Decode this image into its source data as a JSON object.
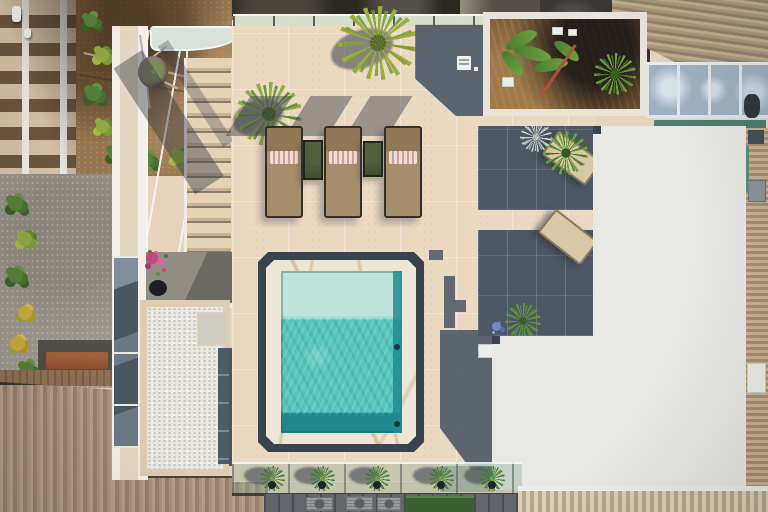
{
  "scene": {
    "type": "aerial-photograph",
    "title": "Top-down drone view of a rooftop terrace with plunge pool, sun loungers and bamboo-slat pergola",
    "lighting": "bright sunlight, shadows cast toward upper-left"
  },
  "palette": {
    "deck_tile": "#ecd9c2",
    "pool_shallow": "#bfe2db",
    "pool_main": "#57c5bc",
    "pool_bench": "#1f888d",
    "marble_surround": "#ede5d6",
    "marble_vein_gold": "#ba8e40",
    "pool_frame_slate": "#39434e",
    "shadow_slate": "#4d5765",
    "pergola_frame": "#e8e9e5",
    "bamboo_light": "#c29a52",
    "bamboo_mid": "#a97f43",
    "bamboo_dark": "#6e5230",
    "glass_panel": "#49545f",
    "lounger_fabric": "#a68d6d",
    "towel_stripe": "#cf9b92",
    "side_table_green": "#47563a",
    "dirt_lot": "#96764f",
    "roof_brown_sw": "#a8917d",
    "roof_corrugated_ne": "#ab997e",
    "pebbles_white": "#e9e7e1",
    "foliage_green": "#55803a",
    "bougainvillea_pink": "#c2487f",
    "teal_glass": "#4f7d71",
    "awning_green": "#3a5f33"
  },
  "terrace": {
    "pool": {
      "shape": "rectangular with chamfered slate border",
      "zones": [
        "pale shallow ledge",
        "turquoise main basin",
        "dark teal bench"
      ],
      "underwater_lights": 2,
      "surround": "white marble with gold veining"
    },
    "sun_loungers": {
      "count": 3,
      "fabric": "taupe",
      "towels": {
        "count": 3,
        "pattern": "pink and white stripes"
      }
    },
    "side_tables": {
      "count": 2,
      "color": "dark green"
    },
    "covered_loungers": {
      "count": 2,
      "fabric": "cream",
      "location": "under glass pergola panels"
    },
    "staircase": {
      "steps_visible": 13,
      "railing": "glass with white stringers",
      "skylight": "sloped glazing beside stairs"
    },
    "pebble_garden": {
      "stone": "white gravel",
      "accents": [
        "grey mat",
        "slate paver strip",
        "bougainvillea pot"
      ]
    },
    "pergola": {
      "infill": "bamboo mats and glass panels",
      "upper_grid": {
        "rows": 4,
        "cols": 3,
        "pattern": [
          [
            "glass",
            "dark",
            "light"
          ],
          [
            "glass",
            "light",
            "light"
          ],
          [
            "glass",
            "mid",
            "light"
          ],
          [
            "glass",
            "light",
            "mid"
          ]
        ]
      },
      "lower_grid": {
        "rows": 3,
        "cols": 5,
        "pattern": [
          [
            "mid",
            "dark",
            "light",
            "dark",
            "light"
          ],
          [
            "mid",
            "light",
            "dark",
            "light",
            "mid"
          ],
          [
            "light",
            "mid",
            "light",
            "dark",
            "mid"
          ]
        ]
      }
    },
    "planter_bed": {
      "plants": [
        "banana",
        "fan palm",
        "red-stem heliconia"
      ],
      "ground": "dry mulch"
    },
    "ground_sign": {
      "legible": false,
      "color": "white"
    }
  },
  "plants": {
    "south_pot_row": {
      "count": 5,
      "type": "spiky agave in dark pots"
    },
    "pot_row_x": [
      272,
      322,
      377,
      441,
      492
    ],
    "pot_row_y": 478,
    "deck_specimens": [
      "yucca at north edge",
      "yucca beside stairs",
      "palm by covered loungers",
      "palm and agapanthus at pergola corner"
    ]
  },
  "surroundings": {
    "north": "dark neighbouring rooftops behind glass balustrade",
    "north_east": "corrugated metal roof, glass conservatory band, teal glazing",
    "east": "tan corrugated neighbour wall",
    "west": "vacant dirt lot with shrubs, tiled roofs, courtyard with rust bench",
    "south_west": "brown corrugated roof",
    "south": "facade strip with air-conditioning units and green awning",
    "ac_units": 3
  }
}
